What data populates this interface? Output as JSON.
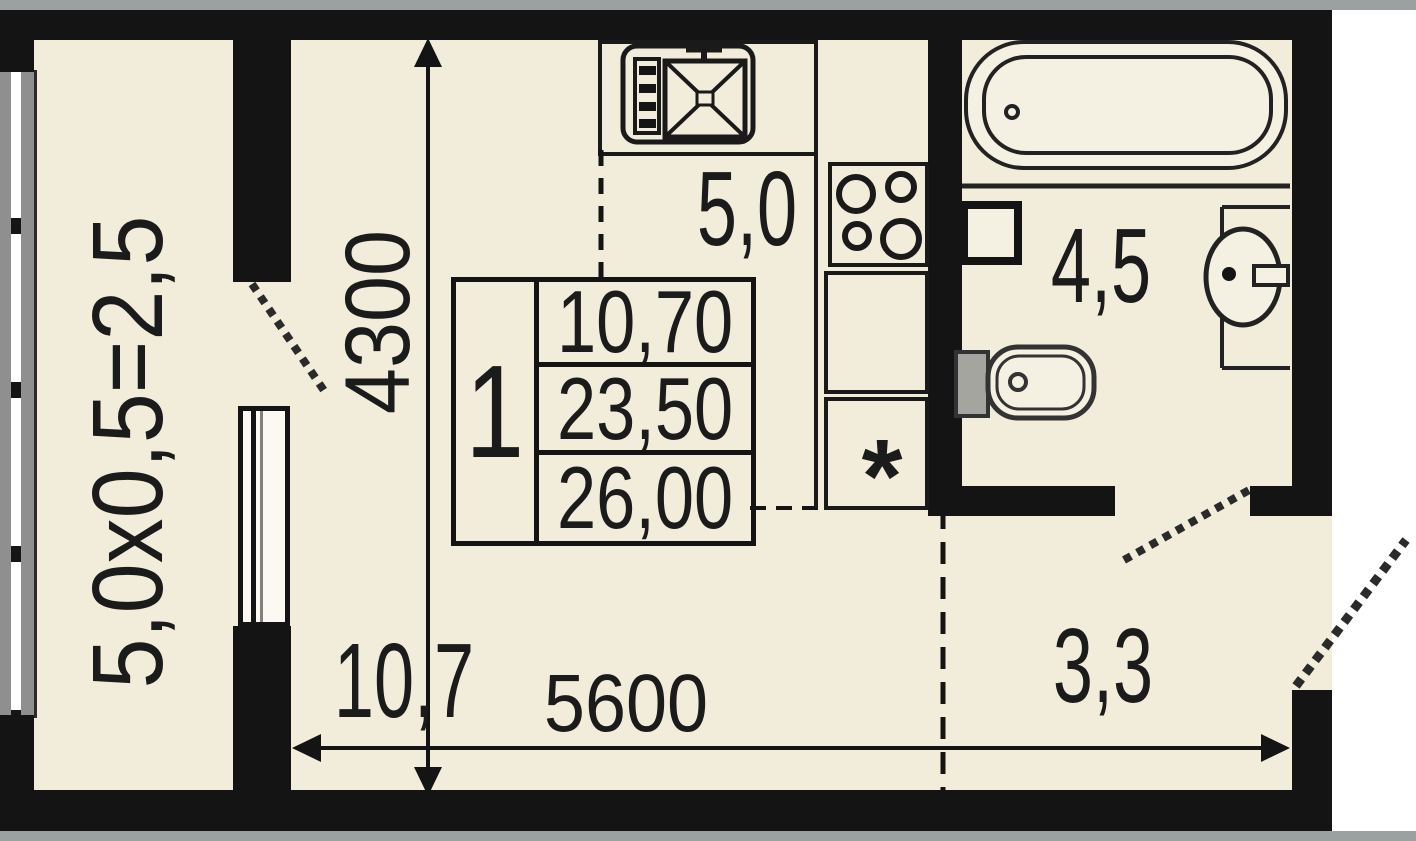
{
  "title": "apartment floor plan",
  "rooms": {
    "balcony": {
      "label": "5,0x0,5=2,5"
    },
    "room": {
      "area": "10,7"
    },
    "kitchen": {
      "area": "5,0"
    },
    "bathroom": {
      "area": "4,5"
    },
    "hallway": {
      "area": "3,3"
    }
  },
  "dimensions": {
    "width": "5600",
    "depth": "4300"
  },
  "info_table": {
    "number": "1",
    "rows": [
      "10,70",
      "23,50",
      "26,00"
    ]
  },
  "marks": {
    "asterisk": "*"
  },
  "colors": {
    "floor": "#f2edda",
    "wall": "#141414",
    "outside": "#ffffff",
    "glazing_gray": "#8f8f8f",
    "edge_strip": "#9ba1a1"
  },
  "fixtures": [
    "bathtub",
    "washbasin",
    "toilet",
    "washing-machine",
    "stove",
    "kitchen-sink",
    "balcony-door",
    "bathroom-door",
    "entrance-door",
    "window",
    "glazed-facade"
  ]
}
